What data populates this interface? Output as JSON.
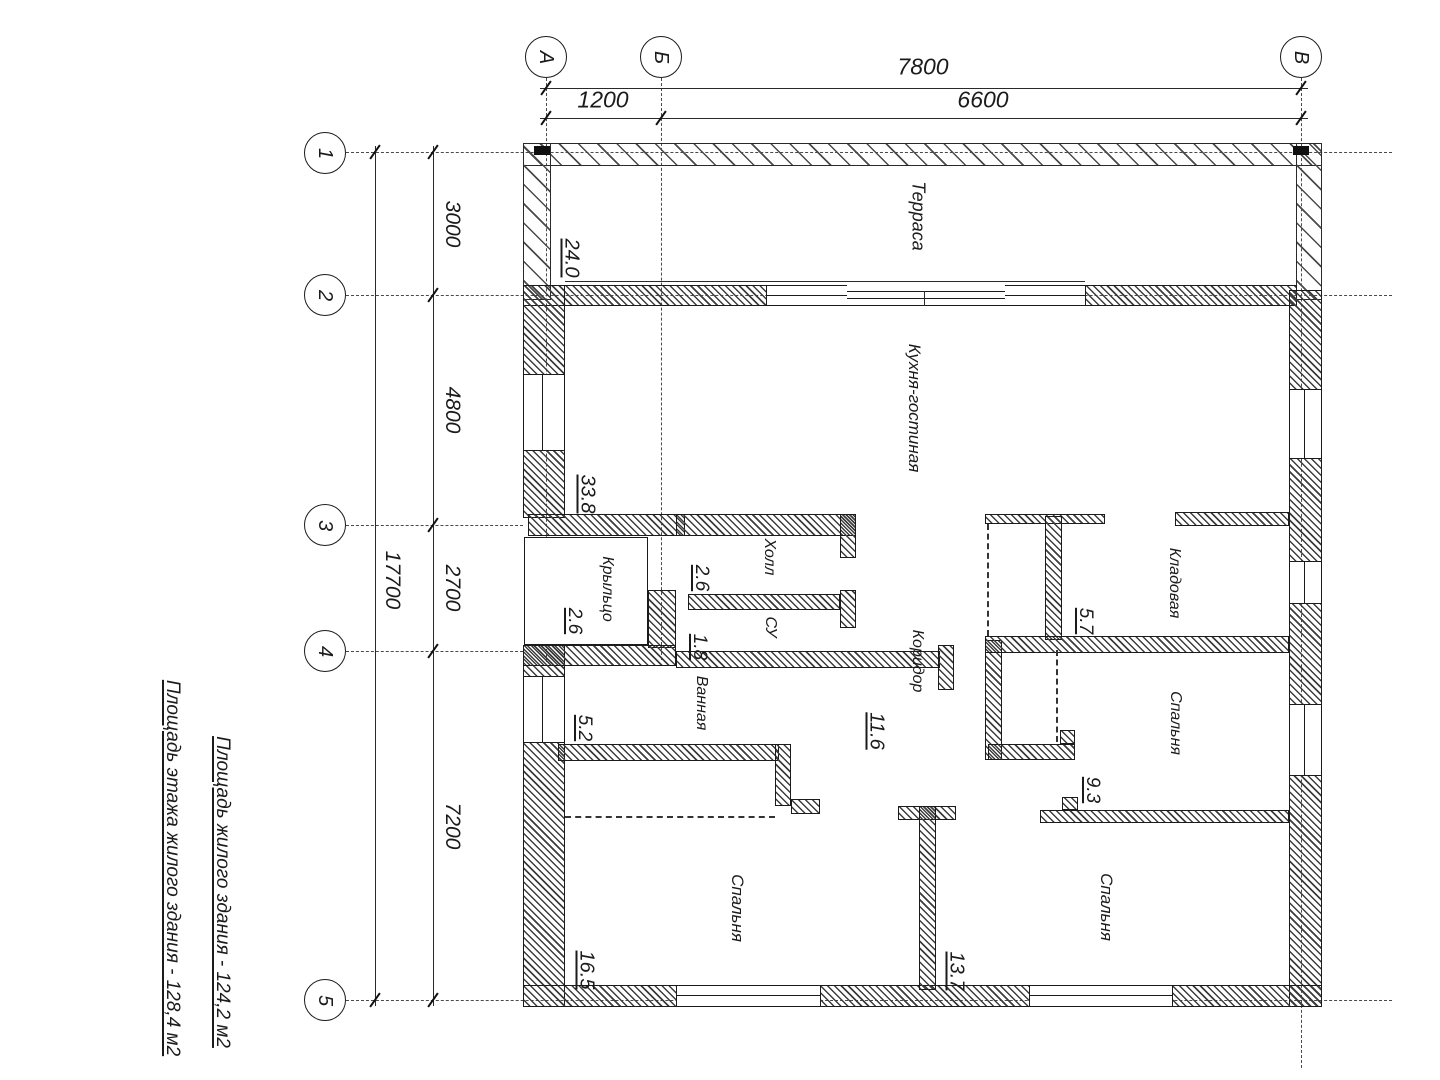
{
  "axes": {
    "a": "А",
    "b": "Б",
    "v": "В",
    "n1": "1",
    "n2": "2",
    "n3": "3",
    "n4": "4",
    "n5": "5"
  },
  "dims": {
    "top_total": "7800",
    "top_ab": "1200",
    "top_bv": "6600",
    "left_total": "17700",
    "left_12": "3000",
    "left_23": "4800",
    "left_34": "2700",
    "left_45": "7200"
  },
  "rooms": [
    {
      "name": "Терраса",
      "area": "24.0"
    },
    {
      "name": "Кухня-гостиная",
      "area": "33.8"
    },
    {
      "name": "Холл",
      "area": "2.6"
    },
    {
      "name": "Крыльцо",
      "area": "2.6"
    },
    {
      "name": "СУ",
      "area": "1.8"
    },
    {
      "name": "Ванная",
      "area": "5.2"
    },
    {
      "name": "Коридор",
      "area": "11.6"
    },
    {
      "name": "Кладовая",
      "area": "5.7"
    },
    {
      "name": "Спальня",
      "area": "9.3"
    },
    {
      "name": "Спальня",
      "area": "16.5"
    },
    {
      "name": "Спальня",
      "area": "13.7"
    }
  ],
  "notes": {
    "line1": "Площадь жилого здания - 124,2 м2",
    "line2": "Площадь этажа жилого здания - 128,4 м2"
  },
  "colors": {
    "ink": "#1b1b1b",
    "paper": "#ffffff"
  }
}
